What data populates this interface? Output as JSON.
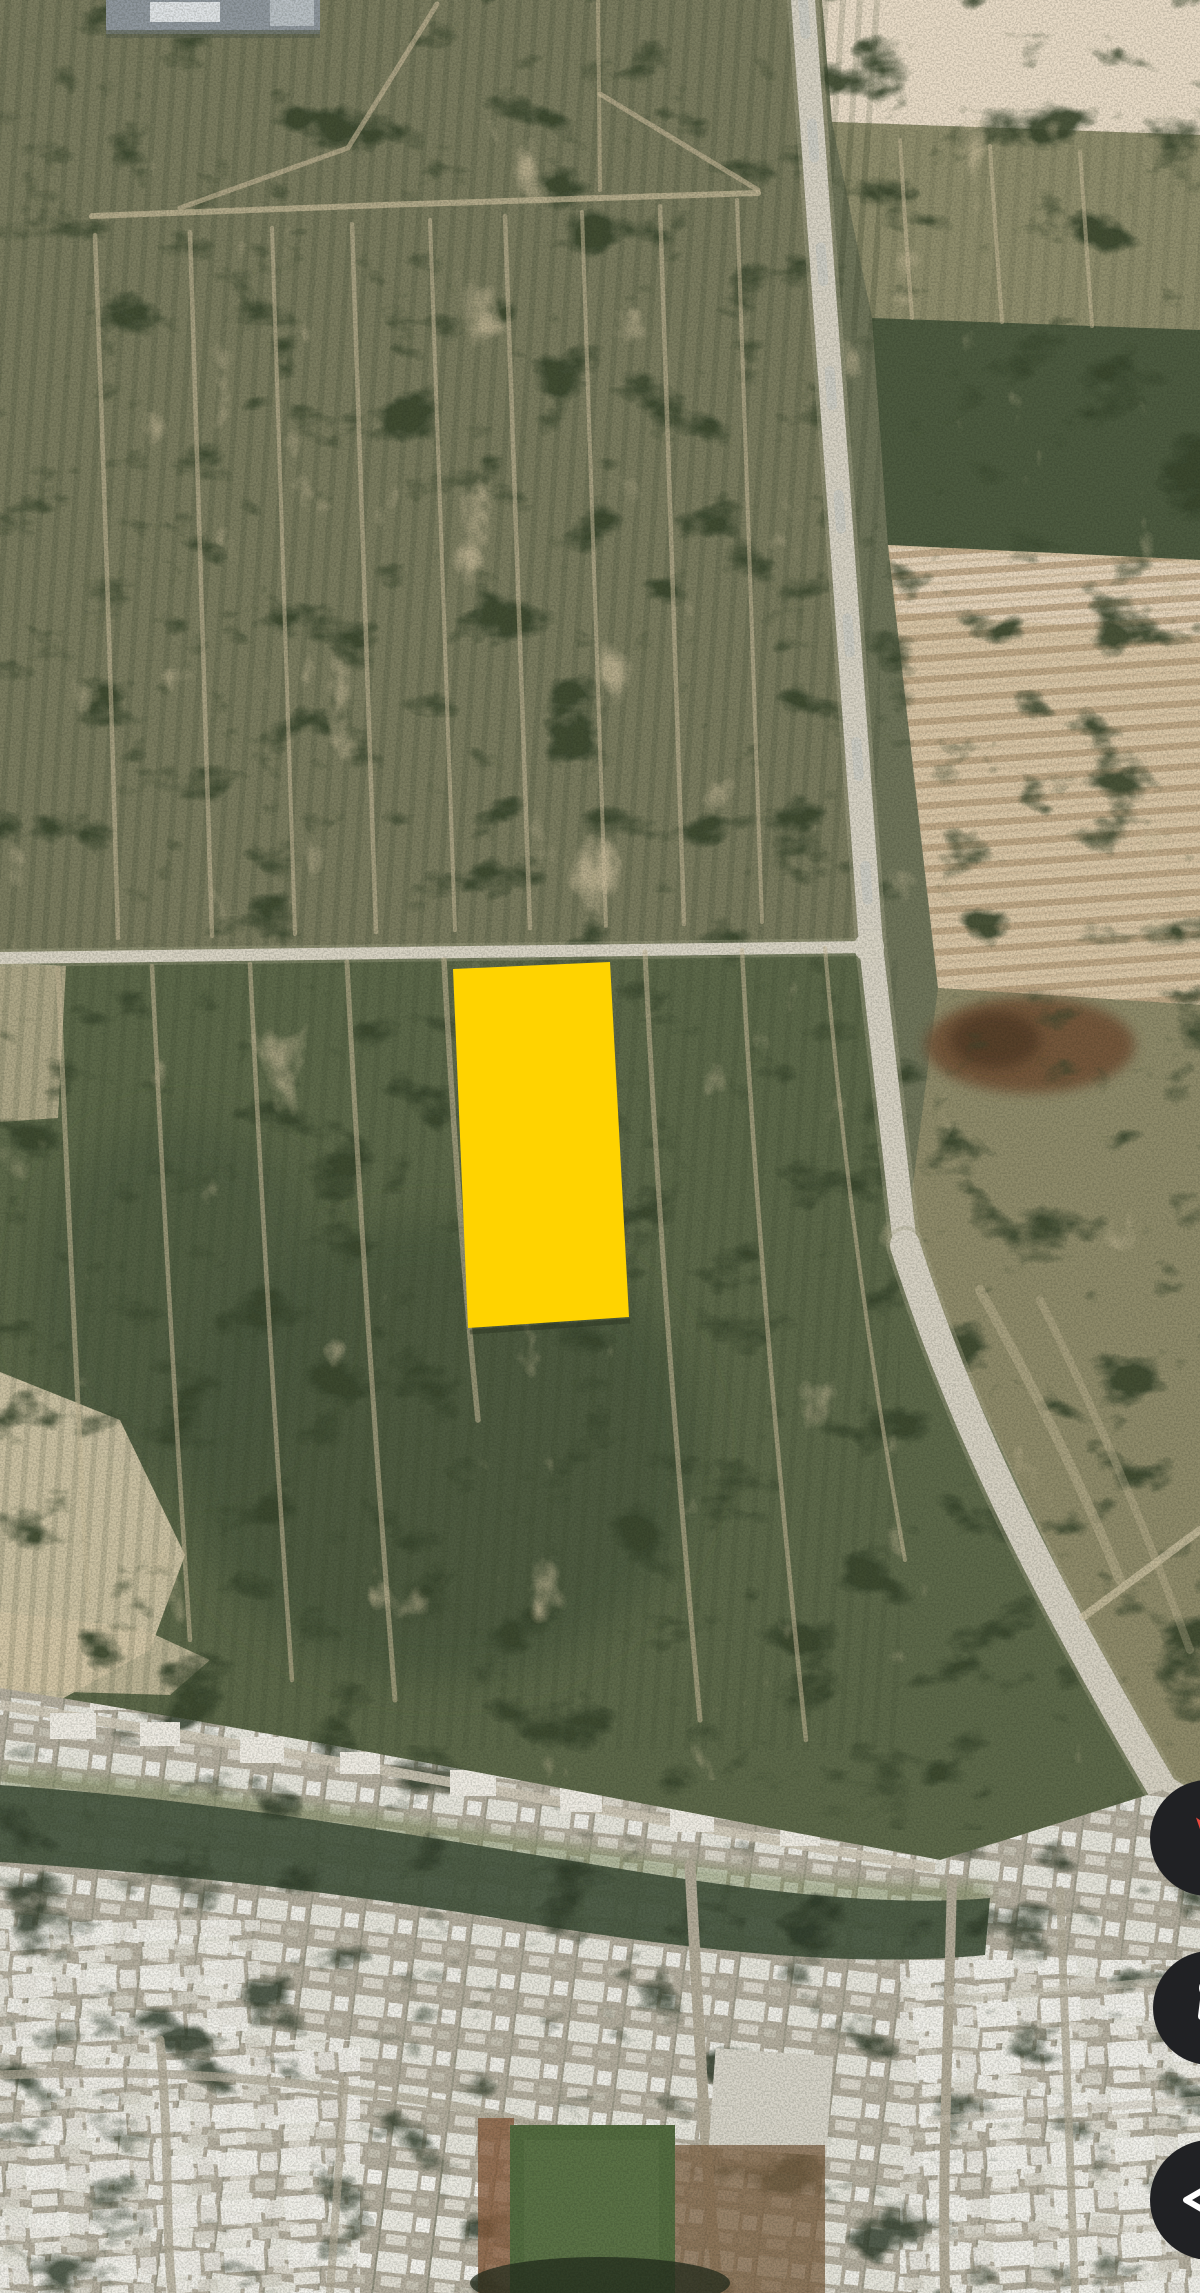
{
  "view": {
    "kind": "mobile-satellite-map-screenshot",
    "width": 1200,
    "height": 2293,
    "visible_text": ""
  },
  "map": {
    "imagery": "aerial satellite photo: olive-green scrubland fields with dirt tracks, tan plowed fields upper right, light roads crossing mid-frame, dense urban blocks and green wadi strip at bottom",
    "features": {
      "parcel_highlight": {
        "fill": "#FFD300",
        "points": "453,969 610,962 629,1317 468,1328"
      }
    }
  },
  "controls": {
    "background": "#202124",
    "icon_color": "#ffffff",
    "buttons": [
      {
        "label": "compass",
        "icon": "compass-icon",
        "north_color": "#e8483f",
        "south_color": "#f4f4f4"
      },
      {
        "label": "street-view",
        "icon": "pegman-icon"
      },
      {
        "label": "collapse-panel",
        "icon": "chevron-left-icon"
      }
    ]
  },
  "palette": {
    "scrub_green": "#6f745a",
    "dark_scrub": "#49553c",
    "sand_track": "#cdbf9e",
    "bare_field": "#e8dbc7",
    "plowed_field": "#d9c6a7",
    "road": "#d6d1c3",
    "urban_base": "#b4ae9f",
    "building_white": "#f3f2ed",
    "wadi_green": "#485640",
    "sports_field_green": "#536b40"
  }
}
